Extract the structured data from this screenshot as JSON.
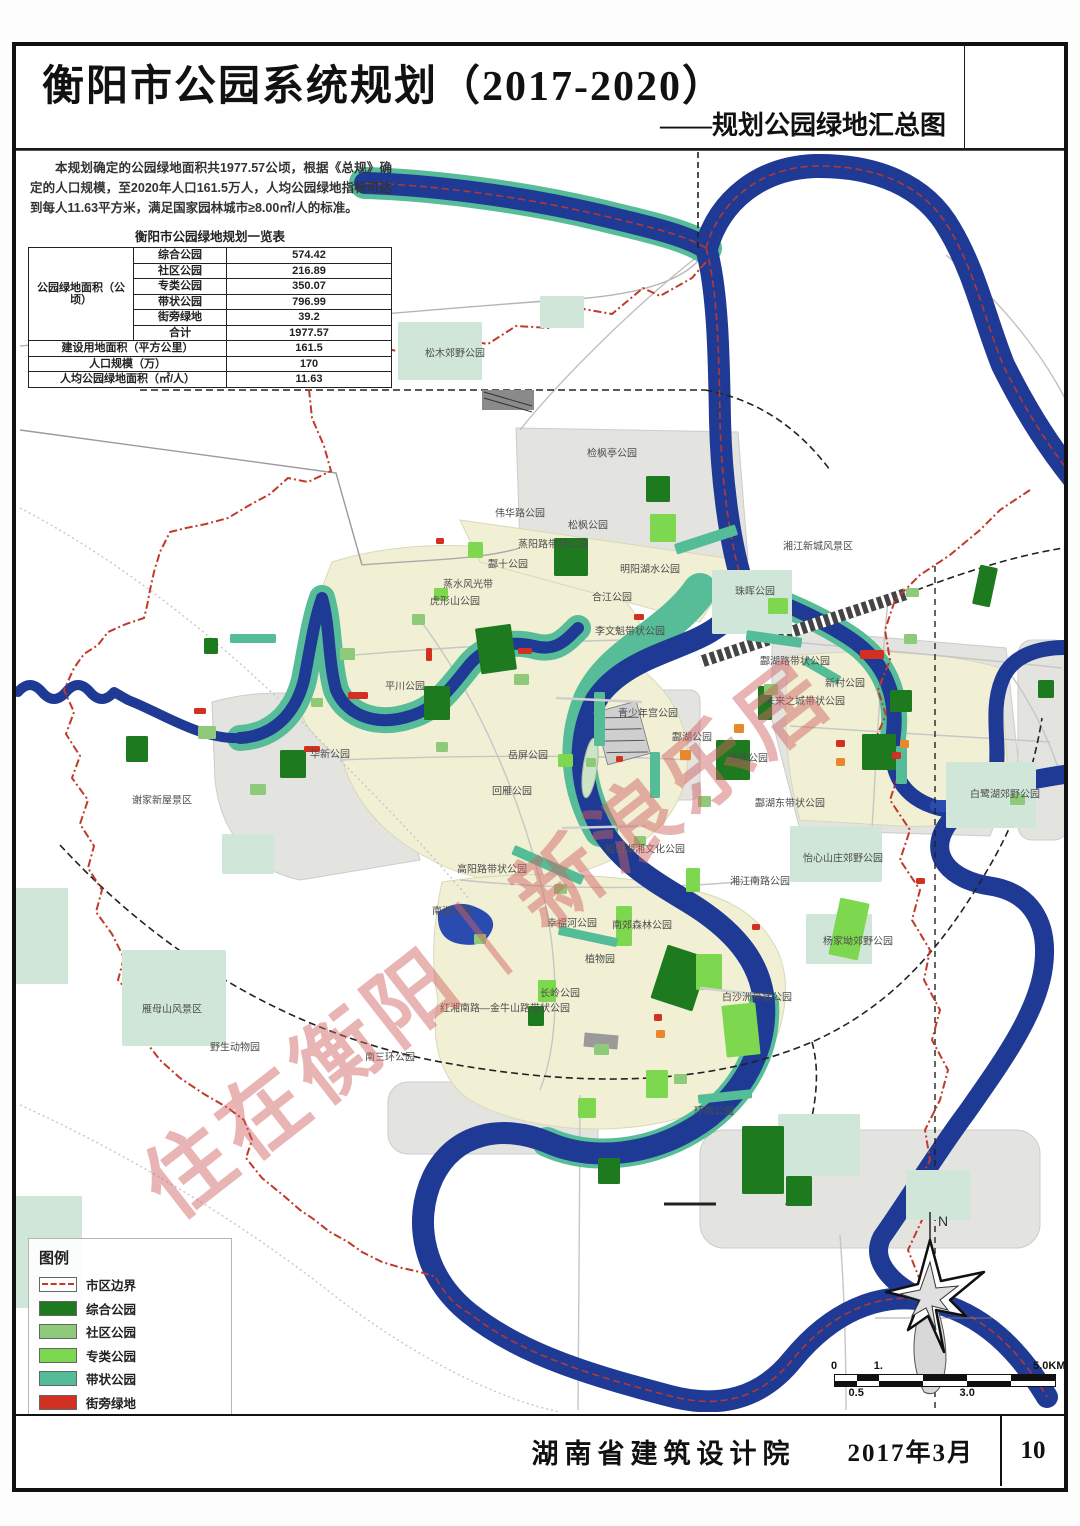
{
  "title_block": {
    "title": "衡阳市公园系统规划（2017-2020）",
    "subtitle": "——规划公园绿地汇总图"
  },
  "intro": {
    "text": "本规划确定的公园绿地面积共1977.57公顷，根据《总规》确定的人口规模，至2020年人口161.5万人，人均公园绿地指标可达到每人11.63平方米，满足国家园林城市≥8.00㎡/人的标准。"
  },
  "table": {
    "title": "衡阳市公园绿地规划一览表",
    "group_label": "公园绿地面积（公顷）",
    "rows": [
      {
        "label": "综合公园",
        "value": "574.42"
      },
      {
        "label": "社区公园",
        "value": "216.89"
      },
      {
        "label": "专类公园",
        "value": "350.07"
      },
      {
        "label": "带状公园",
        "value": "796.99"
      },
      {
        "label": "街旁绿地",
        "value": "39.2"
      },
      {
        "label": "合计",
        "value": "1977.57"
      }
    ],
    "summary_rows": [
      {
        "label": "建设用地面积（平方公里）",
        "value": "161.5"
      },
      {
        "label": "人口规模（万）",
        "value": "170"
      },
      {
        "label": "人均公园绿地面积（㎡/人）",
        "value": "11.63"
      }
    ]
  },
  "legend": {
    "title": "图例",
    "items": [
      {
        "label": "市区边界",
        "kind": "boundary",
        "color": "#c23a2c"
      },
      {
        "label": "综合公园",
        "kind": "swatch",
        "color": "#1e7a1e"
      },
      {
        "label": "社区公园",
        "kind": "swatch",
        "color": "#8fc97a"
      },
      {
        "label": "专类公园",
        "kind": "swatch",
        "color": "#7ed84f"
      },
      {
        "label": "带状公园",
        "kind": "swatch",
        "color": "#54bd97"
      },
      {
        "label": "街旁绿地",
        "kind": "swatch",
        "color": "#d23020"
      },
      {
        "label": "城市广场",
        "kind": "swatch",
        "color": "#e8872b"
      },
      {
        "label": "重点其他绿地",
        "kind": "swatch",
        "color": "#cfe6d8"
      }
    ]
  },
  "scalebar": {
    "labels": [
      {
        "t": "0",
        "p": 0,
        "row": "top"
      },
      {
        "t": "0.5",
        "p": 10,
        "row": "bottom"
      },
      {
        "t": "1.",
        "p": 20,
        "row": "top"
      },
      {
        "t": "3.0",
        "p": 60,
        "row": "bottom"
      },
      {
        "t": "5.0KM",
        "p": 97,
        "row": "top"
      }
    ],
    "segments_pct": [
      10,
      10,
      20,
      20,
      20,
      20
    ]
  },
  "north": {
    "label": "N"
  },
  "watermark": {
    "text": "住在衡阳｜新浪乐居",
    "color": "rgba(206,98,98,0.48)"
  },
  "footer": {
    "org": "湖南省建筑设计院",
    "date": "2017年3月",
    "page": "10"
  },
  "map": {
    "colors": {
      "z": "#1e7a1e",
      "s": "#8fc97a",
      "p": "#7ed84f",
      "d": "#54bd97",
      "j": "#d23020",
      "g": "#e8872b",
      "o": "#cfe6d8",
      "river": "#1e3a94",
      "river_band": "#57bc98",
      "urban": "#f1f0d4",
      "urban_gray": "#e3e3e0",
      "boundary": "#bf3a2b"
    },
    "labels": [
      [
        "松木郊野公园",
        455,
        352
      ],
      [
        "检枫亭公园",
        612,
        452
      ],
      [
        "伟华路公园",
        520,
        512
      ],
      [
        "松枫公园",
        588,
        524
      ],
      [
        "蒸阳路带状公园",
        553,
        543
      ],
      [
        "酃十公园",
        508,
        563
      ],
      [
        "虎形山公园",
        455,
        600
      ],
      [
        "明阳湖水公园",
        650,
        568
      ],
      [
        "合江公园",
        612,
        596
      ],
      [
        "李文魁带状公园",
        630,
        630
      ],
      [
        "珠晖公园",
        755,
        590
      ],
      [
        "湘江新城风景区",
        818,
        545
      ],
      [
        "平川公园",
        405,
        685
      ],
      [
        "华新公园",
        330,
        753
      ],
      [
        "谢家新屋景区",
        162,
        799
      ],
      [
        "蒸水风光带",
        468,
        583
      ],
      [
        "青少年宫公园",
        648,
        712
      ],
      [
        "岳屏公园",
        528,
        754
      ],
      [
        "雁峰公园",
        748,
        757
      ],
      [
        "回雁公园",
        512,
        790
      ],
      [
        "酃湖公园",
        692,
        736
      ],
      [
        "酃湖路带状公园",
        795,
        660
      ],
      [
        "新村公园",
        845,
        682
      ],
      [
        "未来之城带状公园",
        805,
        700
      ],
      [
        "酃湖东带状公园",
        790,
        802
      ],
      [
        "白鹭湖郊野公园",
        1005,
        793
      ],
      [
        "怡心山庄郊野公园",
        843,
        857
      ],
      [
        "湘江南路公园",
        760,
        880
      ],
      [
        "船山湖湘文化公园",
        645,
        848
      ],
      [
        "高阳路带状公园",
        492,
        868
      ],
      [
        "南湖公园",
        452,
        910
      ],
      [
        "幸福河公园",
        572,
        922
      ],
      [
        "南郊森林公园",
        642,
        924
      ],
      [
        "植物园",
        600,
        958
      ],
      [
        "长岭公园",
        560,
        992
      ],
      [
        "红湘南路—金牛山路带状公园",
        505,
        1007
      ],
      [
        "白沙洲带状公园",
        757,
        996
      ],
      [
        "杨家坳郊野公园",
        858,
        940
      ],
      [
        "南三环公园",
        390,
        1056
      ],
      [
        "环南公园",
        714,
        1110
      ],
      [
        "野生动物园",
        235,
        1046
      ],
      [
        "雁母山风景区",
        172,
        1008
      ]
    ],
    "patches": [
      [
        398,
        322,
        84,
        58,
        "o",
        0
      ],
      [
        712,
        570,
        80,
        64,
        "o",
        0
      ],
      [
        946,
        762,
        90,
        66,
        "o",
        0
      ],
      [
        790,
        826,
        92,
        56,
        "o",
        0
      ],
      [
        806,
        914,
        66,
        50,
        "o",
        0
      ],
      [
        122,
        950,
        104,
        96,
        "o",
        0
      ],
      [
        778,
        1114,
        82,
        62,
        "o",
        0
      ],
      [
        16,
        888,
        52,
        96,
        "o",
        0
      ],
      [
        10,
        1196,
        72,
        112,
        "o",
        0
      ],
      [
        540,
        296,
        44,
        32,
        "o",
        0
      ],
      [
        222,
        834,
        52,
        40,
        "o",
        0
      ],
      [
        906,
        1170,
        64,
        50,
        "o",
        0
      ],
      [
        478,
        626,
        36,
        46,
        "z",
        -8
      ],
      [
        554,
        538,
        34,
        38,
        "z",
        0
      ],
      [
        646,
        476,
        24,
        26,
        "z",
        0
      ],
      [
        424,
        686,
        26,
        34,
        "z",
        0
      ],
      [
        280,
        750,
        26,
        28,
        "z",
        0
      ],
      [
        126,
        736,
        22,
        26,
        "z",
        0
      ],
      [
        716,
        740,
        34,
        40,
        "z",
        0
      ],
      [
        862,
        734,
        34,
        36,
        "z",
        0
      ],
      [
        976,
        566,
        18,
        40,
        "z",
        12
      ],
      [
        658,
        950,
        44,
        56,
        "z",
        18
      ],
      [
        742,
        1126,
        42,
        68,
        "z",
        0
      ],
      [
        786,
        1176,
        26,
        30,
        "z",
        0
      ],
      [
        598,
        1158,
        22,
        26,
        "z",
        0
      ],
      [
        890,
        690,
        22,
        22,
        "z",
        0
      ],
      [
        1038,
        680,
        16,
        18,
        "z",
        0
      ],
      [
        528,
        1006,
        16,
        20,
        "z",
        0
      ],
      [
        204,
        638,
        14,
        16,
        "z",
        0
      ],
      [
        758,
        686,
        14,
        34,
        "z",
        0
      ],
      [
        198,
        726,
        18,
        13,
        "s",
        0
      ],
      [
        250,
        784,
        16,
        11,
        "s",
        0
      ],
      [
        340,
        648,
        15,
        12,
        "s",
        0
      ],
      [
        412,
        614,
        13,
        11,
        "s",
        0
      ],
      [
        514,
        674,
        15,
        11,
        "s",
        0
      ],
      [
        698,
        796,
        13,
        11,
        "s",
        0
      ],
      [
        764,
        684,
        14,
        11,
        "s",
        0
      ],
      [
        634,
        836,
        12,
        10,
        "s",
        0
      ],
      [
        554,
        884,
        13,
        10,
        "s",
        0
      ],
      [
        594,
        1044,
        15,
        11,
        "s",
        0
      ],
      [
        674,
        1074,
        13,
        10,
        "s",
        0
      ],
      [
        474,
        934,
        12,
        10,
        "s",
        0
      ],
      [
        904,
        634,
        13,
        10,
        "s",
        0
      ],
      [
        1010,
        794,
        15,
        11,
        "s",
        0
      ],
      [
        436,
        742,
        12,
        10,
        "s",
        0
      ],
      [
        311,
        698,
        12,
        9,
        "s",
        0
      ],
      [
        586,
        758,
        10,
        9,
        "s",
        0
      ],
      [
        906,
        588,
        13,
        9,
        "s",
        0
      ],
      [
        834,
        900,
        30,
        58,
        "p",
        12
      ],
      [
        724,
        1004,
        34,
        52,
        "p",
        -6
      ],
      [
        696,
        954,
        26,
        36,
        "p",
        0
      ],
      [
        646,
        1070,
        22,
        28,
        "p",
        0
      ],
      [
        538,
        980,
        18,
        22,
        "p",
        0
      ],
      [
        650,
        514,
        26,
        28,
        "p",
        0
      ],
      [
        768,
        598,
        20,
        16,
        "p",
        0
      ],
      [
        468,
        542,
        15,
        16,
        "p",
        0
      ],
      [
        558,
        754,
        15,
        13,
        "p",
        0
      ],
      [
        616,
        906,
        16,
        40,
        "p",
        0
      ],
      [
        686,
        868,
        14,
        24,
        "p",
        0
      ],
      [
        578,
        1098,
        18,
        20,
        "p",
        0
      ],
      [
        434,
        588,
        14,
        12,
        "p",
        0
      ],
      [
        674,
        534,
        64,
        11,
        "d",
        -18
      ],
      [
        746,
        634,
        56,
        10,
        "d",
        8
      ],
      [
        510,
        860,
        76,
        10,
        "d",
        24
      ],
      [
        594,
        692,
        11,
        54,
        "d",
        0
      ],
      [
        650,
        752,
        10,
        46,
        "d",
        0
      ],
      [
        896,
        746,
        11,
        38,
        "d",
        0
      ],
      [
        230,
        634,
        46,
        9,
        "d",
        0
      ],
      [
        558,
        932,
        60,
        9,
        "d",
        12
      ],
      [
        698,
        1092,
        54,
        9,
        "d",
        -6
      ],
      [
        802,
        666,
        40,
        9,
        "d",
        30
      ],
      [
        348,
        692,
        20,
        7,
        "j",
        0
      ],
      [
        304,
        746,
        16,
        6,
        "j",
        0
      ],
      [
        194,
        708,
        12,
        6,
        "j",
        0
      ],
      [
        518,
        648,
        14,
        6,
        "j",
        0
      ],
      [
        634,
        614,
        10,
        6,
        "j",
        0
      ],
      [
        860,
        650,
        24,
        9,
        "j",
        0
      ],
      [
        892,
        752,
        9,
        7,
        "j",
        0
      ],
      [
        654,
        1014,
        8,
        7,
        "j",
        0
      ],
      [
        752,
        924,
        8,
        6,
        "j",
        0
      ],
      [
        916,
        878,
        9,
        6,
        "j",
        0
      ],
      [
        426,
        648,
        6,
        13,
        "j",
        0
      ],
      [
        836,
        740,
        9,
        7,
        "j",
        0
      ],
      [
        616,
        756,
        7,
        6,
        "j",
        0
      ],
      [
        436,
        538,
        8,
        6,
        "j",
        0
      ],
      [
        680,
        750,
        11,
        10,
        "g",
        0
      ],
      [
        734,
        724,
        10,
        9,
        "g",
        0
      ],
      [
        656,
        1030,
        9,
        8,
        "g",
        0
      ],
      [
        900,
        740,
        9,
        8,
        "g",
        0
      ],
      [
        836,
        758,
        9,
        8,
        "g",
        0
      ],
      [
        688,
        4,
        20,
        28,
        "p",
        0
      ],
      [
        758,
        8,
        12,
        16,
        "s",
        0
      ],
      [
        812,
        0,
        30,
        36,
        "z",
        0
      ],
      [
        888,
        6,
        26,
        26,
        "s",
        0
      ],
      [
        972,
        10,
        22,
        22,
        "o",
        0
      ]
    ]
  }
}
